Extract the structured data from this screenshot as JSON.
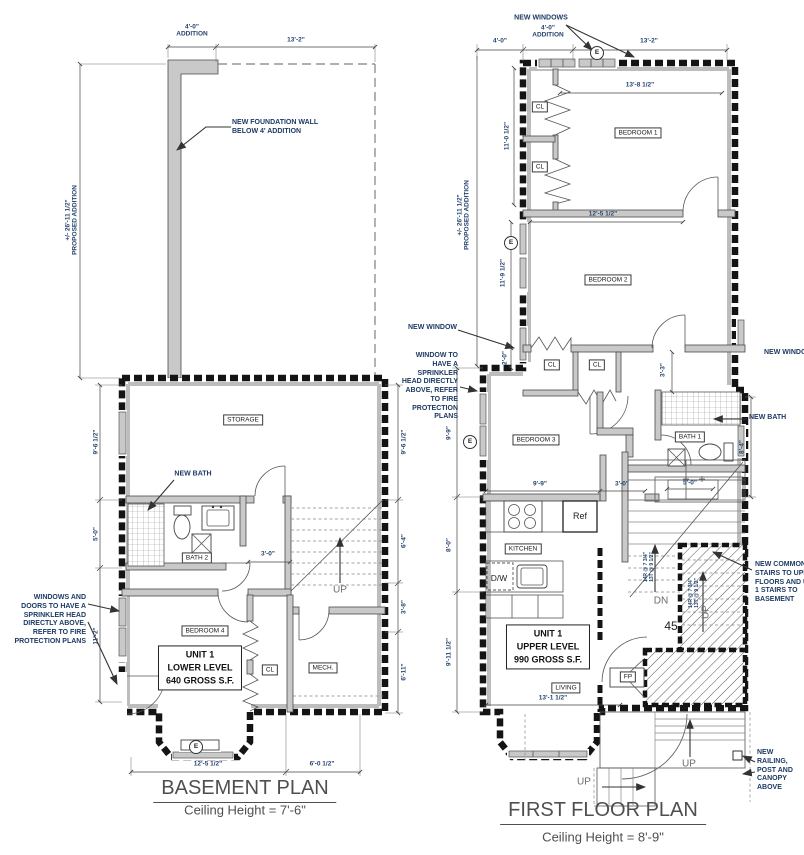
{
  "symbols": {
    "egress": "E"
  },
  "basement": {
    "title": "BASEMENT PLAN",
    "subtitle": "Ceiling Height = 7'-6\"",
    "rooms": {
      "storage": "STORAGE",
      "bath": "BATH 2",
      "bedroom": "BEDROOM 4",
      "closet": "CL",
      "mech": "MECH.",
      "unit": "UNIT 1\nLOWER LEVEL\n640 GROSS S.F.",
      "up": "UP"
    },
    "dims": {
      "addition_width": "4'-0\"\nADDITION",
      "top_width": "13'-2\"",
      "proposed": "+/- 26'-11 1/2\"\nPROPOSED ADDITION",
      "left_1": "9'-6 1/2\"",
      "left_2": "5'-0\"",
      "left_3": "11'-2\"",
      "right_1": "9'-6 1/2\"",
      "right_2": "6'-4\"",
      "right_3": "3'-8\"",
      "right_4": "6'-11\"",
      "bath_door": "3'-0\"",
      "bottom_1": "12'-5 1/2\"",
      "bottom_2": "6'-0 1/2\""
    },
    "annotations": {
      "foundation": "NEW FOUNDATION WALL\nBELOW 4' ADDITION",
      "new_bath": "NEW BATH",
      "sprinkler": "WINDOWS AND\nDOORS TO HAVE  A\nSPRINKLER HEAD\nDIRECTLY ABOVE,\nREFER TO FIRE\nPROTECTION PLANS"
    }
  },
  "first_floor": {
    "title": "FIRST FLOOR PLAN",
    "subtitle": "Ceiling Height = 8'-9\"",
    "rooms": {
      "bedroom1": "BEDROOM 1",
      "bedroom2": "BEDROOM 2",
      "bedroom3": "BEDROOM 3",
      "bath": "BATH 1",
      "kitchen": "KITCHEN",
      "living": "LIVING",
      "closet": "CL",
      "fireplace": "FP",
      "unit": "UNIT 1\nUPPER LEVEL\n990 GROSS S.F.",
      "fridge": "Ref",
      "dishwasher": "D/W",
      "up": "UP",
      "down": "DN",
      "stair_number": "45",
      "stair_note": "14R @ 7 3/4\"\n13T @ 9 1/2\""
    },
    "dims": {
      "top_left": "4'-0\"",
      "addition_width": "4'-0\"\nADDITION",
      "top_width": "13'-2\"",
      "proposed": "+/- 26'-11 1/2\"\nPROPOSED ADDITION",
      "bedroom1_width": "13'-8 1/2\"",
      "bedroom2_width": "12'-5 1/2\"",
      "left_1": "11'-0 1/2\"",
      "left_2": "11'-9 1/2\"",
      "left_3": "2'-0\"",
      "left_4": "9'-9\"",
      "left_5": "8'-0\"",
      "left_6": "9'-11 1/2\"",
      "hall_width": "3'-3\"",
      "bath_height": "8'-4\"",
      "kitchen_width": "9'-9\"",
      "opening": "3'-0\"",
      "vanity": "5'-0\"",
      "living_width": "13'-1 1/2\""
    },
    "annotations": {
      "new_windows": "NEW WINDOWS",
      "new_window_left": "NEW WINDOW",
      "window_sprinkler": "WINDOW TO\nHAVE  A\nSPRINKLER\nHEAD DIRECTLY\nABOVE, REFER\nTO FIRE\nPROTECTION\nPLANS",
      "new_window_right": "NEW WINDOW",
      "new_bath": "NEW BATH",
      "common_stairs": "NEW COMMON\nSTAIRS TO UPPER\nFLOORS AND UNIT\n1 STAIRS TO\nBASEMENT",
      "railing": "NEW RAILING,\nPOST AND\nCANOPY\nABOVE"
    }
  }
}
